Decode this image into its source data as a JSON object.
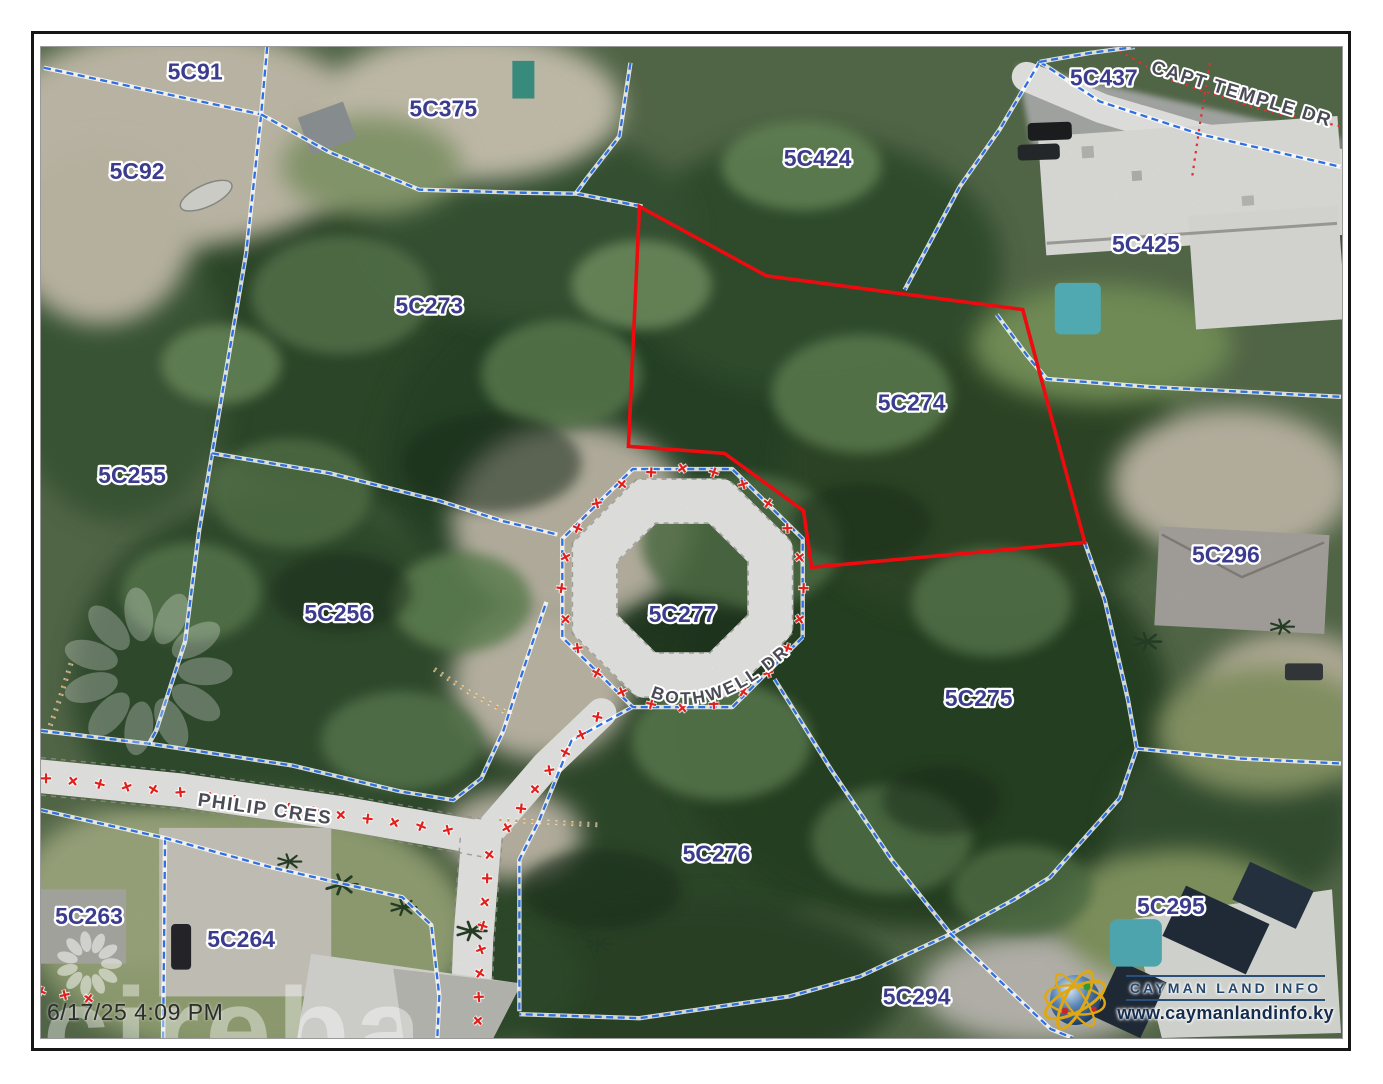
{
  "page": {
    "timestamp": "6/17/25 4:09 PM",
    "watermark_text": "cireba"
  },
  "branding": {
    "logo_title": "CAYMAN LAND INFO",
    "logo_url": "www.caymanlandinfo.ky"
  },
  "map": {
    "highlighted_parcel": "5C274",
    "colors": {
      "parcel_label": "#3c3c8f",
      "road_label": "#4b4b55",
      "boundary_blue": "#2f6fe0",
      "highlight_red": "#ee0b10",
      "survey_cross_red": "#e0201c",
      "tan_dotted": "#c89a54",
      "red_dotted": "#e03030"
    },
    "parcel_labels": [
      {
        "id": "5C91",
        "x": 154,
        "y": 33
      },
      {
        "id": "5C375",
        "x": 402,
        "y": 70
      },
      {
        "id": "5C92",
        "x": 96,
        "y": 133
      },
      {
        "id": "5C424",
        "x": 776,
        "y": 120
      },
      {
        "id": "5C437",
        "x": 1062,
        "y": 39
      },
      {
        "id": "5C425",
        "x": 1104,
        "y": 207
      },
      {
        "id": "5C273",
        "x": 388,
        "y": 269
      },
      {
        "id": "5C274",
        "x": 870,
        "y": 367
      },
      {
        "id": "5C255",
        "x": 91,
        "y": 440
      },
      {
        "id": "5C296",
        "x": 1184,
        "y": 520
      },
      {
        "id": "5C256",
        "x": 297,
        "y": 579
      },
      {
        "id": "5C277",
        "x": 641,
        "y": 580
      },
      {
        "id": "5C275",
        "x": 937,
        "y": 665
      },
      {
        "id": "5C276",
        "x": 675,
        "y": 822
      },
      {
        "id": "5C263",
        "x": 48,
        "y": 885
      },
      {
        "id": "5C264",
        "x": 200,
        "y": 908
      },
      {
        "id": "5C295",
        "x": 1129,
        "y": 875
      },
      {
        "id": "5C294",
        "x": 875,
        "y": 966
      }
    ],
    "road_labels": [
      {
        "name": "CAPT TEMPLE DR",
        "x": 1198,
        "y": 53,
        "rotate": 17
      },
      {
        "name": "PHILIP CRES",
        "x": 223,
        "y": 775,
        "rotate": 8
      },
      {
        "name": "BOTHWELL DR",
        "arc": "M 598,650 Q 674,696 780,580"
      }
    ],
    "highlight_polygon": [
      [
        598,
        161
      ],
      [
        725,
        231
      ],
      [
        981,
        265
      ],
      [
        1043,
        500
      ],
      [
        770,
        525
      ],
      [
        762,
        468
      ],
      [
        683,
        410
      ],
      [
        587,
        403
      ]
    ],
    "boundaries": [
      [
        [
          3,
          21
        ],
        [
          220,
          68
        ]
      ],
      [
        [
          226,
          0
        ],
        [
          220,
          68
        ],
        [
          205,
          208
        ],
        [
          171,
          410
        ],
        [
          158,
          488
        ],
        [
          144,
          600
        ],
        [
          115,
          690
        ],
        [
          108,
          703
        ]
      ],
      [
        [
          220,
          68
        ],
        [
          288,
          106
        ],
        [
          378,
          144
        ],
        [
          478,
          147
        ],
        [
          535,
          148
        ],
        [
          601,
          161
        ]
      ],
      [
        [
          589,
          16
        ],
        [
          578,
          90
        ],
        [
          545,
          133
        ],
        [
          535,
          147
        ]
      ],
      [
        [
          171,
          410
        ],
        [
          288,
          430
        ],
        [
          398,
          458
        ],
        [
          460,
          478
        ],
        [
          516,
          492
        ]
      ],
      [
        [
          998,
          15
        ],
        [
          958,
          83
        ],
        [
          918,
          141
        ],
        [
          863,
          245
        ]
      ],
      [
        [
          998,
          15
        ],
        [
          1058,
          55
        ],
        [
          1158,
          88
        ],
        [
          1299,
          121
        ]
      ],
      [
        [
          998,
          15
        ],
        [
          1048,
          6
        ],
        [
          1093,
          0
        ]
      ],
      [
        [
          955,
          270
        ],
        [
          985,
          311
        ],
        [
          1005,
          335
        ],
        [
          1108,
          343
        ],
        [
          1299,
          353
        ]
      ],
      [
        [
          1043,
          500
        ],
        [
          1063,
          558
        ],
        [
          1086,
          658
        ],
        [
          1095,
          708
        ],
        [
          1078,
          758
        ],
        [
          1008,
          838
        ],
        [
          971,
          861
        ],
        [
          909,
          895
        ],
        [
          818,
          938
        ],
        [
          748,
          958
        ],
        [
          598,
          980
        ],
        [
          478,
          976
        ]
      ],
      [
        [
          1095,
          708
        ],
        [
          1198,
          718
        ],
        [
          1299,
          723
        ]
      ],
      [
        [
          733,
          638
        ],
        [
          790,
          730
        ],
        [
          850,
          820
        ],
        [
          909,
          895
        ],
        [
          966,
          950
        ],
        [
          1009,
          991
        ],
        [
          1031,
          1000
        ]
      ],
      [
        [
          0,
          690
        ],
        [
          108,
          703
        ],
        [
          251,
          725
        ],
        [
          358,
          751
        ],
        [
          412,
          760
        ],
        [
          440,
          738
        ],
        [
          462,
          690
        ],
        [
          483,
          625
        ],
        [
          505,
          560
        ]
      ],
      [
        [
          124,
          798
        ],
        [
          122,
          1000
        ]
      ],
      [
        [
          0,
          770
        ],
        [
          123,
          798
        ],
        [
          231,
          828
        ],
        [
          361,
          858
        ],
        [
          390,
          886
        ],
        [
          398,
          958
        ],
        [
          396,
          1000
        ]
      ],
      [
        [
          591,
          666
        ],
        [
          530,
          700
        ],
        [
          498,
          780
        ],
        [
          478,
          820
        ],
        [
          478,
          900
        ],
        [
          478,
          973
        ]
      ]
    ],
    "ring": {
      "cx": 641,
      "cy": 546,
      "r_boundary": 130,
      "r_road": 95,
      "road_width": 46,
      "r_cross": 121
    },
    "red_dotted": [
      [
        [
          1071,
          0
        ],
        [
          1128,
          33
        ],
        [
          1218,
          63
        ],
        [
          1299,
          80
        ]
      ],
      [
        [
          1168,
          16
        ],
        [
          1158,
          78
        ],
        [
          1150,
          133
        ]
      ]
    ],
    "tan_dotted": [
      [
        [
          393,
          628
        ],
        [
          428,
          651
        ],
        [
          473,
          676
        ]
      ],
      [
        [
          458,
          780
        ],
        [
          503,
          782
        ],
        [
          558,
          785
        ]
      ],
      [
        [
          30,
          622
        ],
        [
          18,
          660
        ],
        [
          6,
          694
        ]
      ]
    ],
    "roads": {
      "philip": [
        [
          0,
          736
        ],
        [
          140,
          750
        ],
        [
          300,
          773
        ],
        [
          440,
          798
        ]
      ],
      "south": [
        [
          440,
          798
        ],
        [
          432,
          900
        ],
        [
          428,
          1002
        ]
      ],
      "spur": [
        [
          445,
          795
        ],
        [
          505,
          725
        ],
        [
          560,
          672
        ]
      ],
      "capt": [
        [
          985,
          30
        ],
        [
          1060,
          62
        ],
        [
          1160,
          92
        ],
        [
          1299,
          118
        ]
      ]
    },
    "cross_lines": [
      {
        "pts": [
          [
            5,
            738
          ],
          [
            140,
            752
          ],
          [
            300,
            775
          ],
          [
            428,
            793
          ]
        ],
        "spacing": 27
      },
      {
        "pts": [
          [
            448,
            815
          ],
          [
            440,
            900
          ],
          [
            436,
            995
          ]
        ],
        "spacing": 24
      },
      {
        "pts": [
          [
            556,
            676
          ],
          [
            505,
            733
          ],
          [
            462,
            793
          ]
        ],
        "spacing": 24
      },
      {
        "pts": [
          [
            0,
            953
          ],
          [
            60,
            962
          ]
        ],
        "spacing": 24
      }
    ]
  }
}
